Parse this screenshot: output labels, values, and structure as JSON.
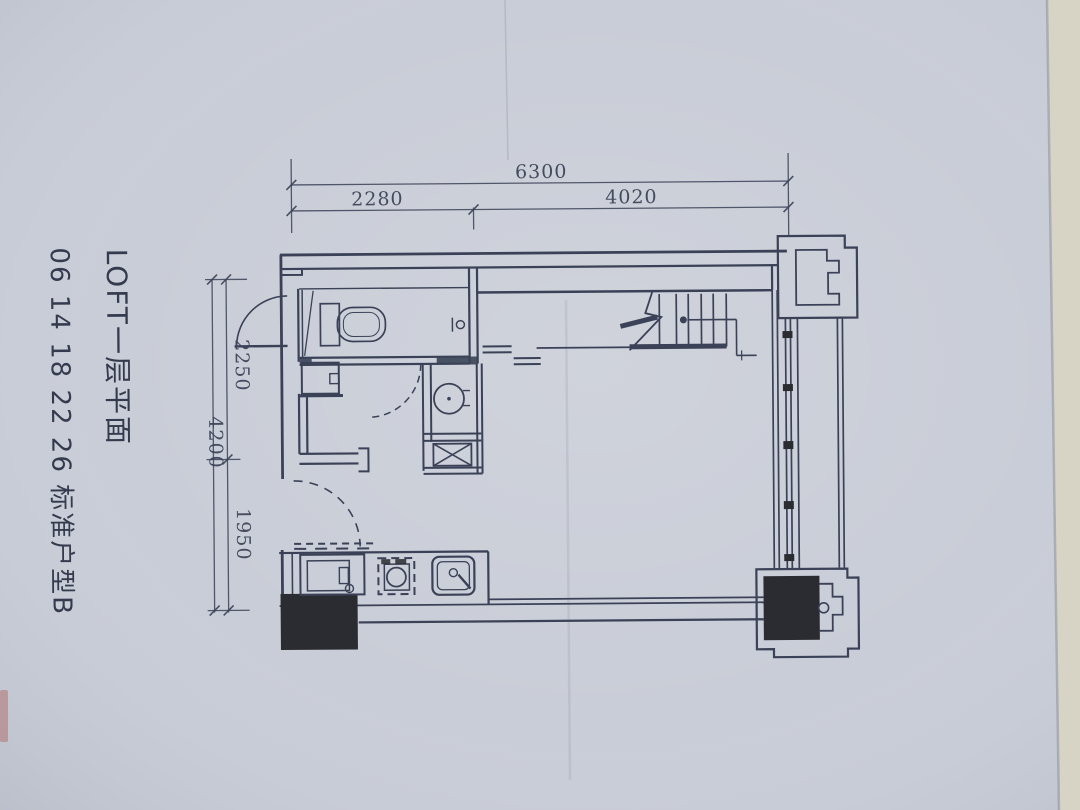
{
  "photo": {
    "description": "Photographed architectural floor-plan sheet of a loft apartment, first level",
    "titles": {
      "plan_title": "LOFT一层平面",
      "unit_label": "06 14 18 22 26  标准户型B"
    },
    "dimensions_top": {
      "total": "6300",
      "left_segment": "2280",
      "right_segment": "4020"
    },
    "dimensions_left": {
      "total": "4200",
      "top_segment": "2250",
      "bottom_segment": "1950"
    },
    "colors": {
      "paper": "#c9cdd7",
      "ink": "#3b4257",
      "black": "#2b2c31",
      "desk": "#d7d4c6"
    }
  },
  "colors": {
    "paper": "#c9cdd7",
    "ink": "#3b4257",
    "black": "#2b2c31",
    "desk": "#d7d4c6"
  }
}
